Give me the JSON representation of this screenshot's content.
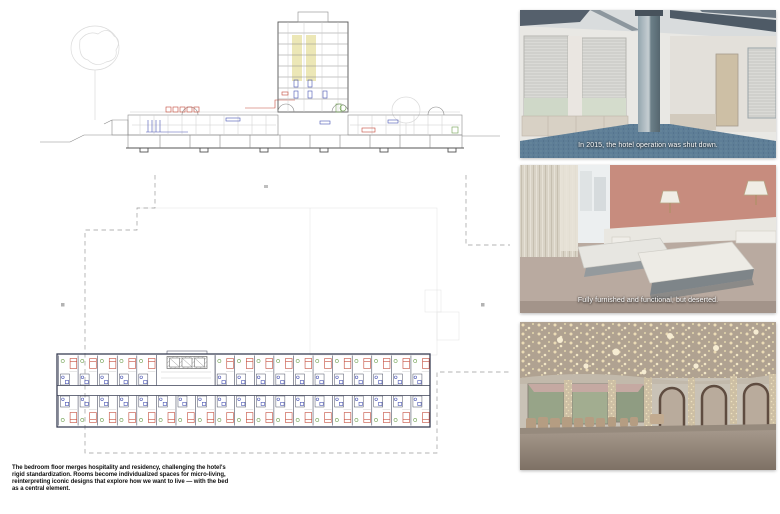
{
  "board_title": "hotel transformation presentation board",
  "colors": {
    "plan_wall": "#3a3f55",
    "accent_red": "#c44a3a",
    "accent_blue": "#4a55b4",
    "accent_green": "#6fa050",
    "accent_yellow": "#ece7b6",
    "dash_gray": "#9a9a9a",
    "carpet_blue": "#5e7e97",
    "bedroom_pink": "#c78c7e",
    "ballroom_gold": "#e8d9b4",
    "caption_white": "#ffffff"
  },
  "drawings": {
    "section": {
      "name": "building section with tower and podium"
    },
    "floor_plan": {
      "name": "bedroom floor plan",
      "bays_top": 19,
      "bays_bottom": 19,
      "core_start": 5,
      "core_end": 7,
      "bay_width": 19.58
    }
  },
  "photos": [
    {
      "name": "abandoned hotel lounge",
      "caption": "In 2015, the hotel operation was shut down."
    },
    {
      "name": "deserted hotel bedroom",
      "caption": "Fully furnished and functional, but deserted."
    },
    {
      "name": "empty ballroom with chandeliers",
      "caption": ""
    }
  ],
  "caption": {
    "lines": [
      "The bedroom floor merges hospitality and residency, challenging the hotel's",
      "rigid standardization. Rooms become individualized spaces for micro-living,",
      "reinterpreting iconic designs that explore how we want to live — with the bed",
      "as a central element."
    ]
  }
}
